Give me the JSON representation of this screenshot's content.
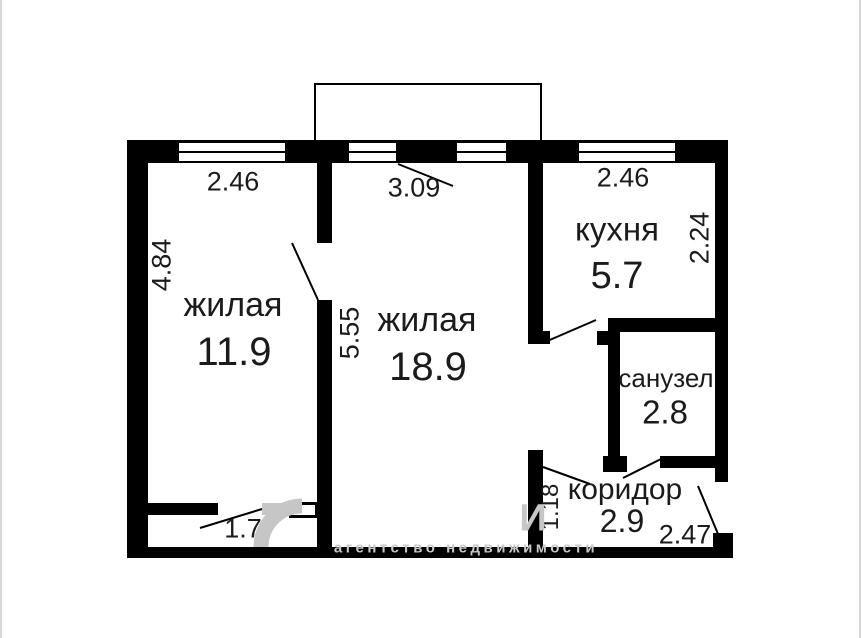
{
  "plan": {
    "rooms": [
      {
        "name": "жилая",
        "area": "11.9"
      },
      {
        "name": "жилая",
        "area": "18.9"
      },
      {
        "name": "кухня",
        "area": "5.7"
      },
      {
        "name": "санузел",
        "area": "2.8"
      },
      {
        "name": "коридор",
        "area": "2.9"
      }
    ],
    "dimensions": {
      "room1_window": "2.46",
      "balcony_width": "3.09",
      "kitchen_window": "2.46",
      "room1_left_side": "4.84",
      "rooms_divider": "5.55",
      "kitchen_right_side": "2.24",
      "room1_door_width": "1.7",
      "corridor_left_side": "1.18",
      "corridor_bottom": "2.47"
    },
    "watermark": {
      "logo_letter": "И",
      "agency_text": "агентство недвижимости"
    },
    "colors": {
      "wall": "#000000",
      "label_text": "#1b1b1b",
      "watermark_gray": "#c6c6c6"
    }
  }
}
